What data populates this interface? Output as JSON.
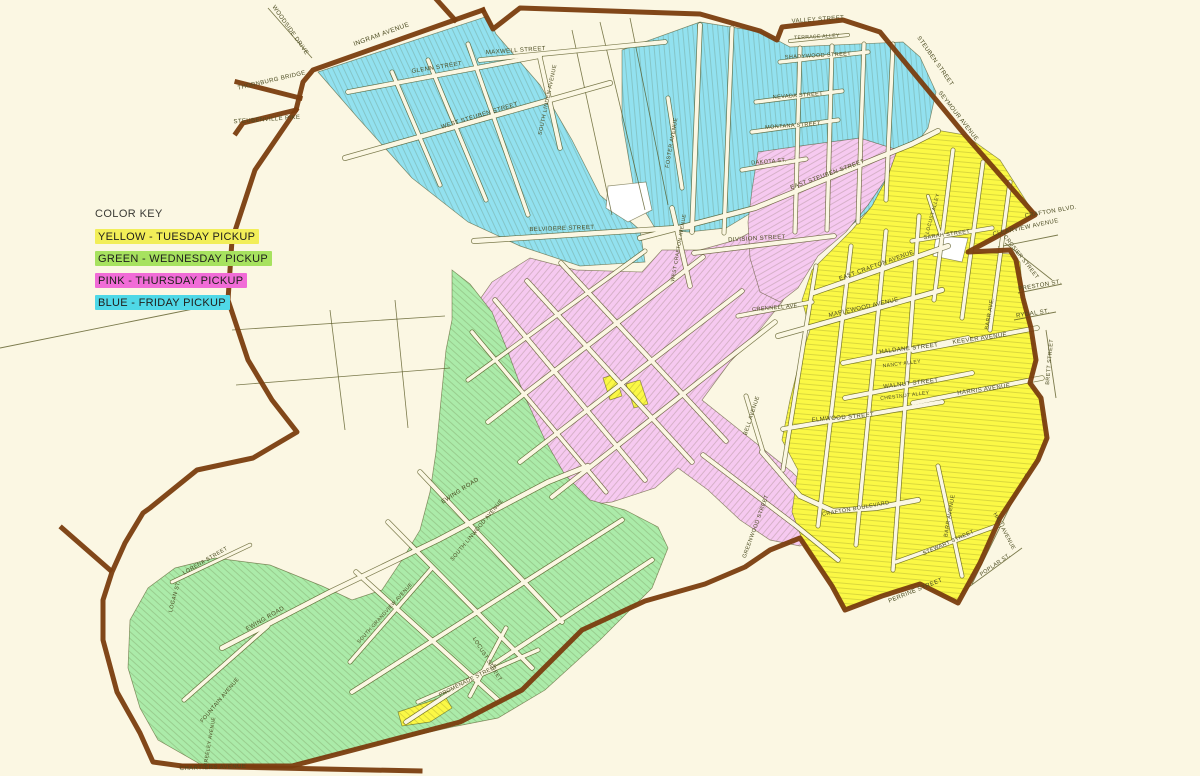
{
  "color_key": {
    "title": "COLOR KEY",
    "entries": [
      {
        "label": "YELLOW - TUESDAY PICKUP",
        "color": "#F2EE58"
      },
      {
        "label": "GREEN - WEDNESDAY PICKUP",
        "color": "#A7E25F"
      },
      {
        "label": "PINK - THURSDAY PICKUP",
        "color": "#F16CD7"
      },
      {
        "label": "BLUE - FRIDAY PICKUP",
        "color": "#4FD8E7"
      }
    ]
  },
  "palette": {
    "background": "#FBF7E3",
    "boundary": "#7A3D0E",
    "street_fill": "#FBF7E3",
    "street_casing": "rgba(80,80,25,0.75)",
    "zone_outline": "rgba(60,60,10,0.55)",
    "hatch": "rgba(70,70,20,0.30)",
    "label_color": "#4A4A20",
    "white_pocket": "#FFFFFF"
  },
  "map": {
    "zones": [
      {
        "name": "friday-blue-west",
        "color": "#92E1EF",
        "hatch_angle": -25,
        "points": "318,72 488,16 496,34 540,85 572,140 600,195 640,230 645,262 580,266 520,246 468,222 412,178 358,118"
      },
      {
        "name": "friday-blue-east",
        "color": "#92E1EF",
        "hatch_angle": -5,
        "points": "622,50 700,22 762,32 790,47 903,42 920,57 936,92 928,128 898,168 875,205 848,228 800,233 756,210 726,228 688,232 655,228 635,195 622,120"
      },
      {
        "name": "thursday-pink-main",
        "color": "#F6C9F0",
        "hatch_angle": 40,
        "points": "492,282 530,258 576,270 642,272 662,250 700,250 736,240 762,226 790,242 800,268 782,302 758,332 730,362 702,400 742,432 792,472 822,502 826,532 800,546 770,540 740,520 708,490 678,468 655,488 612,502 578,506 556,482 530,452 506,420 488,390 472,358 470,330 478,302"
      },
      {
        "name": "thursday-pink-northeast",
        "color": "#F6C9F0",
        "hatch_angle": 60,
        "points": "758,152 800,146 860,138 898,150 888,176 868,205 846,232 818,256 798,288 780,302 760,292 750,258 748,222 752,190"
      },
      {
        "name": "tuesday-yellow-main",
        "color": "#FBF845",
        "hatch_angle": 95,
        "points": "898,148 936,130 965,135 1000,160 1035,215 996,237 968,252 1012,254 1020,262 1023,298 1031,328 1036,360 1030,383 1041,398 1047,438 1038,460 1000,518 978,565 958,602 918,584 880,596 843,610 830,580 806,550 792,512 798,470 782,440 790,400 800,360 810,330 802,300 812,270 832,250 852,230 872,206 888,176"
      },
      {
        "name": "wednesday-green-main",
        "color": "#ABEBA9",
        "hatch_angle": -48,
        "points": "452,270 470,284 492,312 508,352 524,395 545,440 565,475 590,500 625,510 658,527 668,548 652,588 600,640 545,690 498,718 452,727 360,748 292,764 200,764 158,740 140,708 128,668 130,620 148,588 175,568 215,558 270,565 322,586 352,600 382,590 402,560 420,530 430,492 436,452 441,400 446,350 452,320"
      },
      {
        "name": "tuesday-yellow-island-a",
        "color": "#FBF845",
        "hatch_angle": 40,
        "points": "603,378 615,374 622,396 610,400"
      },
      {
        "name": "tuesday-yellow-island-b",
        "color": "#FBF845",
        "hatch_angle": 40,
        "points": "626,384 640,380 648,404 634,408"
      },
      {
        "name": "tuesday-yellow-island-south",
        "color": "#FBF845",
        "hatch_angle": -48,
        "points": "398,712 428,702 445,696 452,708 430,722 402,726"
      }
    ],
    "white_pockets": [
      {
        "name": "school-pocket",
        "points": "608,186 646,182 652,210 628,222 606,208"
      },
      {
        "name": "crafton-blvd-pocket",
        "points": "936,236 968,238 962,262 933,256"
      }
    ],
    "boundary": {
      "width": 5,
      "segments": [
        "483,10 313,70 303,82 296,110 243,123 236,133",
        "237,82 300,98",
        "437,0 455,20",
        "296,110 255,170 232,240 228,300 248,360 272,400 297,432 253,458 197,470 150,508 143,513 125,543 112,572 103,600 103,640 117,692 140,733 153,762 182,766 292,766 460,722 522,690 582,630 645,601 705,584 745,567 770,550 800,538 812,556 832,586 845,610 882,596 920,584 958,603 980,563 1000,518 1038,460 1047,438 1041,398 1030,383 1036,360 1031,328 1023,298 1016,260 1010,250 968,252 996,237 1035,215 965,135 880,32 843,20 782,27 777,40 760,31 700,14 520,8 493,29 483,10",
        "182,766 420,771",
        "62,528 110,570"
      ]
    },
    "roads": [
      {
        "p": "345,158 610,83",
        "w": 4.5
      },
      {
        "p": "348,92 540,56",
        "w": 4
      },
      {
        "p": "480,60 665,42",
        "w": 4
      },
      {
        "p": "540,58 560,148",
        "w": 4
      },
      {
        "p": "392,72 440,185",
        "w": 3.5
      },
      {
        "p": "428,60 486,200",
        "w": 3.5
      },
      {
        "p": "468,44 528,215",
        "w": 3.5
      },
      {
        "p": "700,25 692,232",
        "w": 4
      },
      {
        "p": "732,28 724,233",
        "w": 3.5
      },
      {
        "p": "668,98 682,188",
        "w": 3.5
      },
      {
        "p": "672,208 690,286",
        "w": 4
      },
      {
        "p": "800,48 795,232",
        "w": 3.5
      },
      {
        "p": "832,46 827,230",
        "w": 3.5
      },
      {
        "p": "864,44 858,222",
        "w": 3.5
      },
      {
        "p": "893,44 886,200",
        "w": 3.5
      },
      {
        "p": "780,62 868,52",
        "w": 3.5
      },
      {
        "p": "756,102 842,91",
        "w": 3.5
      },
      {
        "p": "752,132 838,120",
        "w": 3.5
      },
      {
        "p": "742,170 806,159",
        "w": 3.5
      },
      {
        "p": "790,41 848,35",
        "w": 2.5
      },
      {
        "p": "640,238 755,208 912,144 938,131",
        "w": 4.5
      },
      {
        "p": "474,241 692,227",
        "w": 4.5
      },
      {
        "p": "694,253 834,236",
        "w": 4
      },
      {
        "p": "495,300 645,480",
        "w": 4
      },
      {
        "p": "527,281 692,462",
        "w": 4
      },
      {
        "p": "561,263 726,441",
        "w": 4
      },
      {
        "p": "472,332 606,492",
        "w": 3.5
      },
      {
        "p": "488,422 703,257",
        "w": 4
      },
      {
        "p": "520,462 742,291",
        "w": 4
      },
      {
        "p": "552,497 775,322",
        "w": 4
      },
      {
        "p": "468,380 645,251",
        "w": 3.5
      },
      {
        "p": "703,455 795,525 838,560",
        "w": 4
      },
      {
        "p": "222,648 330,592 438,540 548,482 588,466",
        "w": 4.5
      },
      {
        "p": "420,472 562,622",
        "w": 4
      },
      {
        "p": "388,522 532,668",
        "w": 4
      },
      {
        "p": "356,572 498,700",
        "w": 4
      },
      {
        "p": "352,692 622,520",
        "w": 4
      },
      {
        "p": "406,722 652,560",
        "w": 4
      },
      {
        "p": "350,662 432,568",
        "w": 3.5
      },
      {
        "p": "184,700 268,626",
        "w": 3.5
      },
      {
        "p": "172,582 250,545",
        "w": 3
      },
      {
        "p": "418,702 538,650",
        "w": 3.5
      },
      {
        "p": "470,696 506,628",
        "w": 3.5
      },
      {
        "p": "778,336 942,290",
        "w": 4.5
      },
      {
        "p": "843,363 968,338",
        "w": 4
      },
      {
        "p": "845,398 972,373",
        "w": 4
      },
      {
        "p": "783,429 942,402",
        "w": 4
      },
      {
        "p": "913,403 1042,378",
        "w": 4
      },
      {
        "p": "913,351 1037,328",
        "w": 4
      },
      {
        "p": "738,316 812,302",
        "w": 3.5
      },
      {
        "p": "813,293 948,246",
        "w": 4.5
      },
      {
        "p": "912,241 992,228",
        "w": 3.5
      },
      {
        "p": "816,266 783,470",
        "w": 3.5
      },
      {
        "p": "851,246 818,526",
        "w": 3.5
      },
      {
        "p": "886,231 856,545",
        "w": 3.5
      },
      {
        "p": "919,216 893,570",
        "w": 3.5
      },
      {
        "p": "953,150 934,300",
        "w": 3.5
      },
      {
        "p": "983,162 962,318",
        "w": 3.5
      },
      {
        "p": "1010,182 990,330",
        "w": 3.5
      },
      {
        "p": "762,452 800,496 833,511 876,508 918,500",
        "w": 4.5
      },
      {
        "p": "896,562 1002,524",
        "w": 3.5
      },
      {
        "p": "938,466 962,576",
        "w": 3.5
      },
      {
        "p": "928,196 941,236",
        "w": 2.5
      },
      {
        "p": "746,396 763,452",
        "w": 3.5
      }
    ],
    "lines": [
      {
        "p": "0,348 228,302",
        "w": 0.9
      },
      {
        "p": "232,330 445,316",
        "w": 0.8
      },
      {
        "p": "236,385 450,368",
        "w": 0.8
      },
      {
        "p": "330,310 345,430",
        "w": 0.8
      },
      {
        "p": "395,300 408,428",
        "w": 0.8
      },
      {
        "p": "572,30 612,215",
        "w": 0.8
      },
      {
        "p": "600,22 645,210",
        "w": 0.8
      },
      {
        "p": "630,18 668,205",
        "w": 0.8
      },
      {
        "p": "268,8 312,58",
        "w": 0.9
      },
      {
        "p": "1005,243 1052,280",
        "w": 0.9
      },
      {
        "p": "998,247 1058,235",
        "w": 0.9
      },
      {
        "p": "1018,293 1062,284",
        "w": 0.9
      },
      {
        "p": "1014,320 1056,312",
        "w": 0.9
      },
      {
        "p": "1046,330 1056,398",
        "w": 0.9
      },
      {
        "p": "962,592 1022,548",
        "w": 0.9
      },
      {
        "p": "972,584 1026,474",
        "w": 0.9
      }
    ],
    "labels": [
      [
        "WOODSIDE DRIVE",
        289,
        31,
        55,
        6
      ],
      [
        "THORNBURG BRIDGE",
        272,
        82,
        -13,
        6
      ],
      [
        "STEUBENVILLE PIKE",
        267,
        121,
        -4,
        6
      ],
      [
        "INGRAM AVENUE",
        382,
        36,
        -20,
        6.5
      ],
      [
        "MAXWELL STREET",
        516,
        52,
        -4,
        6
      ],
      [
        "GLENN STREET",
        437,
        69,
        -9,
        6
      ],
      [
        "WEST STEUBEN STREET",
        480,
        117,
        -17,
        6
      ],
      [
        "SOUTH LINDEN AVENUE",
        549,
        100,
        -78,
        5.5
      ],
      [
        "FOSTER AVENUE",
        673,
        143,
        -80,
        5.5
      ],
      [
        "BELVIDERE STREET",
        562,
        230,
        -2,
        6
      ],
      [
        "WEST CRAFTON AVENUE",
        680,
        248,
        -80,
        5
      ],
      [
        "EAST STEUBEN STREET",
        828,
        176,
        -20,
        6
      ],
      [
        "DAKOTA ST.",
        769,
        163,
        -5,
        5.5
      ],
      [
        "MONTANA STREET",
        793,
        127,
        -4,
        5.5
      ],
      [
        "NEVADA STREET",
        798,
        97,
        -4,
        5.5
      ],
      [
        "SHADYWOOD STREET",
        818,
        57,
        -3,
        5.5
      ],
      [
        "TERRACE ALLEY",
        817,
        38,
        -3,
        5
      ],
      [
        "VALLEY STREET",
        818,
        21,
        -4,
        6
      ],
      [
        "STEUBEN STREET",
        934,
        62,
        55,
        6
      ],
      [
        "SEYMOUR AVENUE",
        957,
        117,
        52,
        6
      ],
      [
        "CRAFTON BLVD.",
        1051,
        213,
        -10,
        6
      ],
      [
        "CLEARVIEW AVENUE",
        1026,
        229,
        -12,
        6
      ],
      [
        "CROSIER STREET",
        1020,
        258,
        52,
        5.5
      ],
      [
        "SARAH STREET",
        947,
        236,
        -8,
        5.5
      ],
      [
        "LOCUST ALLEY",
        934,
        214,
        -75,
        5
      ],
      [
        "EAST CRAFTON AVENUE",
        877,
        267,
        -20,
        6
      ],
      [
        "DIVISION STREET",
        757,
        240,
        -3,
        6
      ],
      [
        "CRENNELL AVE.",
        776,
        309,
        -5,
        5.5
      ],
      [
        "MAPLEWOOD AVENUE",
        864,
        309,
        -13,
        6
      ],
      [
        "HALDANE STREET",
        909,
        350,
        -7,
        6
      ],
      [
        "WALNUT STREET",
        911,
        385,
        -7,
        6
      ],
      [
        "CHESTNUT ALLEY",
        905,
        397,
        -7,
        5
      ],
      [
        "ELMWOOD STREET",
        843,
        419,
        -5,
        6
      ],
      [
        "BELL AVENUE",
        753,
        416,
        -72,
        5.5
      ],
      [
        "NANCY ALLEY",
        902,
        365,
        -7,
        5
      ],
      [
        "KEEVER AVENUE",
        980,
        340,
        -8,
        6
      ],
      [
        "HARRIS AVENUE",
        984,
        391,
        -8,
        6
      ],
      [
        "BARR AVE.",
        991,
        314,
        -80,
        5.5
      ],
      [
        "PRESTON ST.",
        1040,
        287,
        -10,
        6
      ],
      [
        "RYDAL ST.",
        1033,
        315,
        -8,
        6
      ],
      [
        "BRETT STREET",
        1051,
        362,
        -85,
        5.5
      ],
      [
        "HALL AVENUE",
        1003,
        532,
        62,
        5.5
      ],
      [
        "POPLAR ST.",
        996,
        566,
        -35,
        5.5
      ],
      [
        "STEWART STREET",
        949,
        544,
        -24,
        5.5
      ],
      [
        "PERRINE STREET",
        916,
        592,
        -22,
        6
      ],
      [
        "BARR AVENUE",
        951,
        516,
        -80,
        5.5
      ],
      [
        "CRAFTON BOULEVARD",
        856,
        510,
        -10,
        5.5
      ],
      [
        "GREENWOOD STREET",
        757,
        527,
        -70,
        5.5
      ],
      [
        "EWING ROAD",
        266,
        620,
        -30,
        6
      ],
      [
        "EWING ROAD",
        461,
        492,
        -33,
        6
      ],
      [
        "SOUTH LINWOOD AVENUE",
        478,
        531,
        -50,
        5.5
      ],
      [
        "SOUTH GRANDVIEW AVENUE",
        386,
        614,
        -48,
        5
      ],
      [
        "LORENA STREET",
        206,
        562,
        -30,
        5.5
      ],
      [
        "LOGAN ST.",
        176,
        597,
        -75,
        5.5
      ],
      [
        "FOUNTAIN AVENUE",
        221,
        701,
        -50,
        5.5
      ],
      [
        "GREELEY AVENUE",
        211,
        742,
        -80,
        5
      ],
      [
        "CHARTIERS AVENUE",
        213,
        769,
        -2,
        6
      ],
      [
        "PROMENADE STREET",
        469,
        682,
        -27,
        5.5
      ],
      [
        "LOCUST STREET",
        486,
        660,
        58,
        5.5
      ]
    ]
  }
}
